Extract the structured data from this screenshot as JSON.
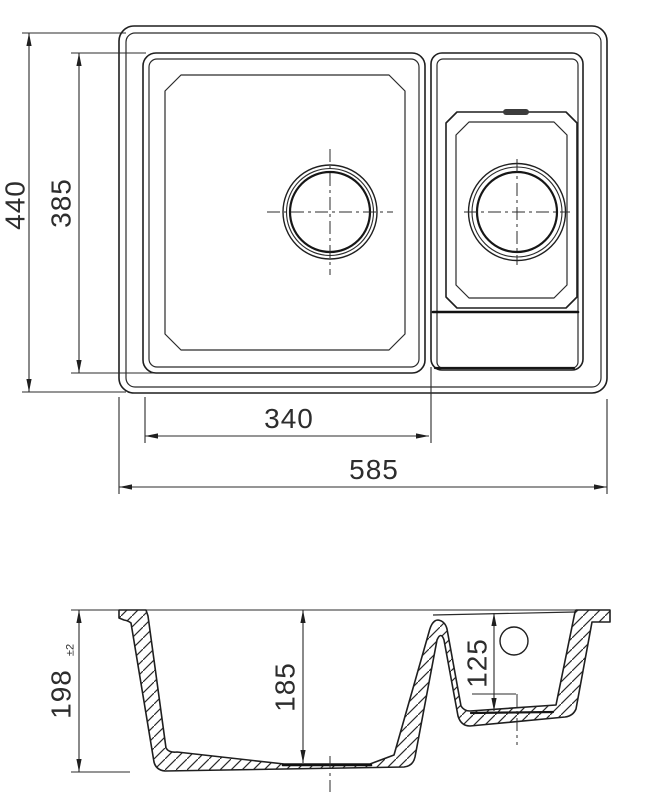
{
  "drawing": {
    "subject": "one-and-a-half bowl kitchen sink, dimensioned technical drawing",
    "background_color": "#ffffff",
    "line_color": "#1f1f1f",
    "views": {
      "plan": {
        "label": "plan-view",
        "dimensions": {
          "overall_depth": "440",
          "main_bowl_depth": "385",
          "main_bowl_width": "340",
          "overall_width": "585"
        }
      },
      "section": {
        "label": "section-view",
        "dimensions": {
          "overall_height": "198",
          "overall_height_tolerance": "±2",
          "main_bowl_height": "185",
          "half_bowl_height": "125"
        }
      }
    }
  }
}
